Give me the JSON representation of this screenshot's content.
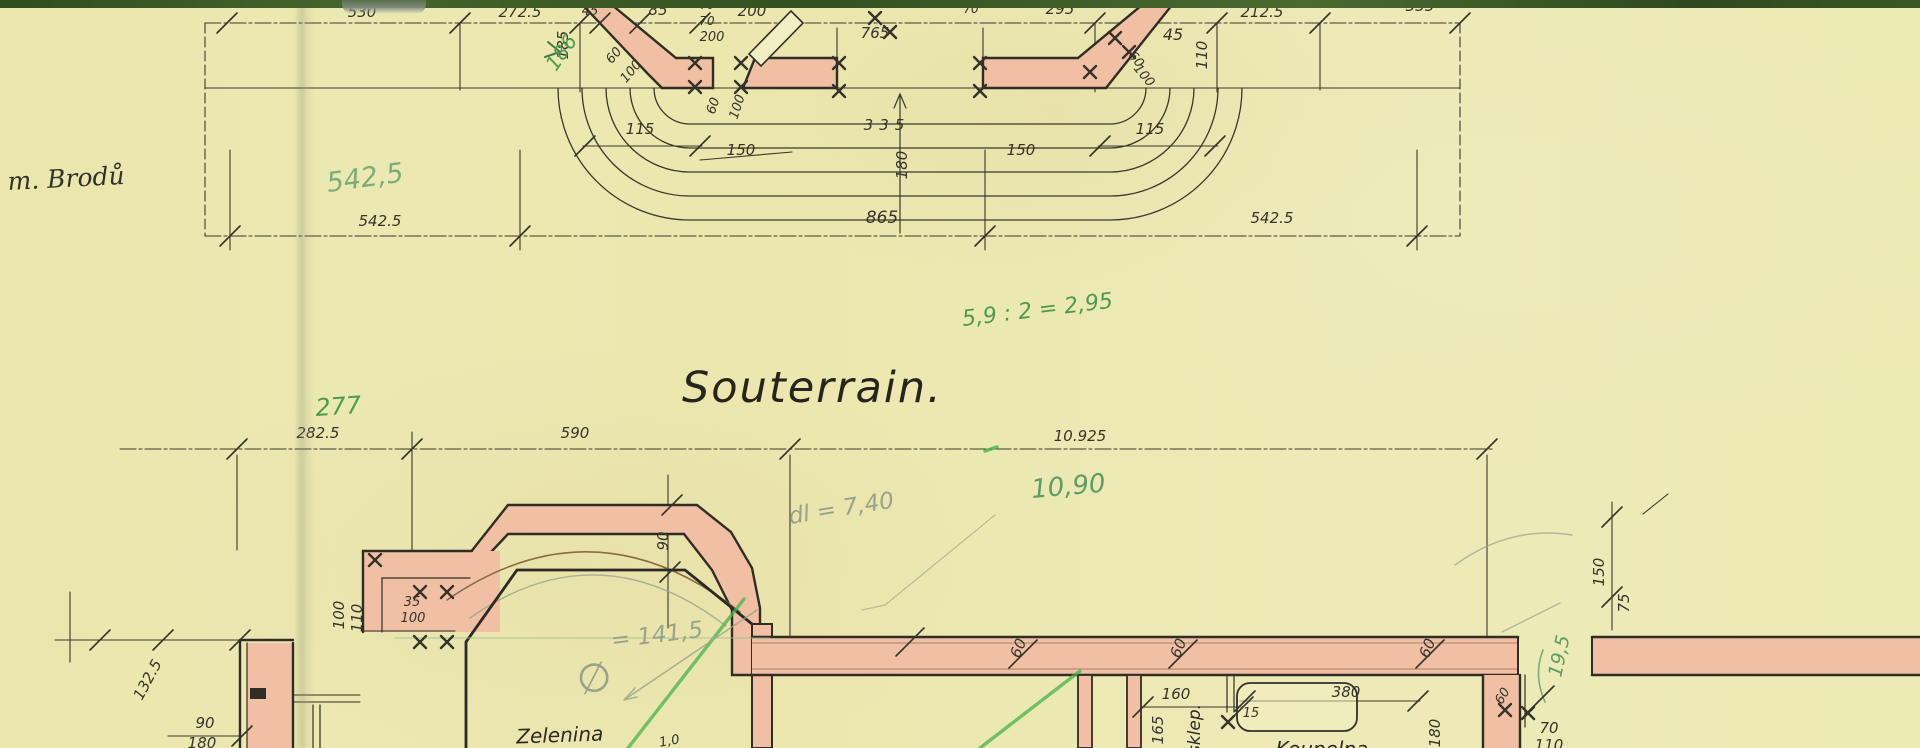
{
  "title": "Souterrain.",
  "handwritten": {
    "owner_note": "m. Brodů",
    "green_542_5": "542,5",
    "green_186": "186",
    "green_calc": "5,9 : 2 = 2,95",
    "green_277": "277",
    "green_10_90": "10,90",
    "pencil_dl": "dl = 7,40",
    "pencil_dia_sym": "∅",
    "pencil_dia_val": "= 141,5",
    "green_19_5": "19,5",
    "small_1_0": "1,0"
  },
  "top_detail": {
    "dims": {
      "d530": "530",
      "d272_5": "272.5",
      "d185": "185",
      "d45": "45",
      "d85": "85",
      "d70": "70",
      "d200": "200",
      "d765": "765",
      "d295": "295",
      "d212_5": "212.5",
      "d335": "335",
      "d110": "110",
      "d60": "60",
      "d100": "100",
      "d115": "115",
      "d150": "150",
      "d180": "180",
      "d865": "865",
      "d542_5": "542.5"
    }
  },
  "plan": {
    "dims": {
      "d282_5": "282.5",
      "d590": "590",
      "d10_925": "10.925",
      "d35": "35",
      "d100": "100",
      "d110": "110",
      "d132_5": "132.5",
      "d90": "90",
      "d180": "180",
      "d60": "60",
      "d160": "160",
      "d165": "165",
      "d15": "15",
      "d380": "380",
      "d70": "70",
      "d150": "150",
      "d75": "75"
    },
    "rooms": {
      "zelenina": "Zelenina",
      "sklep": "sklep.",
      "koupelna": "Koupelna"
    }
  },
  "colors": {
    "paper": "#ece8b2",
    "wall_fill": "#f1bfa4",
    "ink": "#35332a",
    "green_pen": "#4d9a52",
    "pencil_gray": "#99a28b",
    "scan_edge_green": "#3b5723"
  }
}
